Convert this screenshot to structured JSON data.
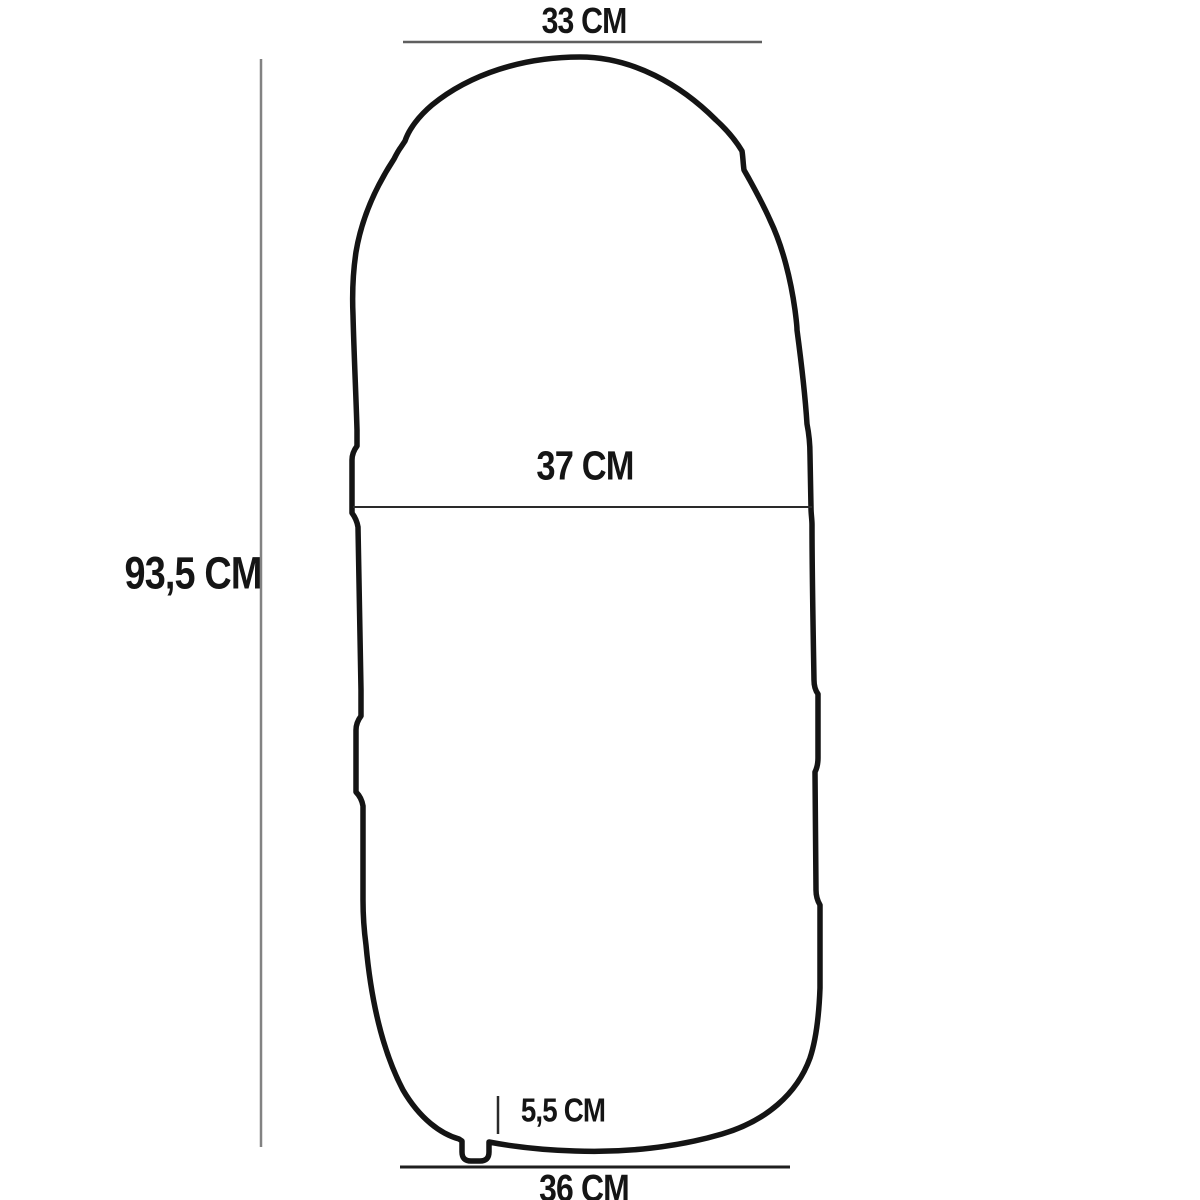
{
  "diagram": {
    "type": "dimension-drawing",
    "subject": "sleeping-bag-outline",
    "labels": {
      "top_width": "33 CM",
      "middle_width": "37 CM",
      "total_height": "93,5 CM",
      "valve_height": "5,5 CM",
      "bottom_width": "36 CM"
    },
    "colors": {
      "background": "#ffffff",
      "outline": "#141414",
      "dimension_line_gray": "#7f7f7f",
      "dimension_line_dark": "#2a2a2a",
      "text": "#151515"
    }
  }
}
